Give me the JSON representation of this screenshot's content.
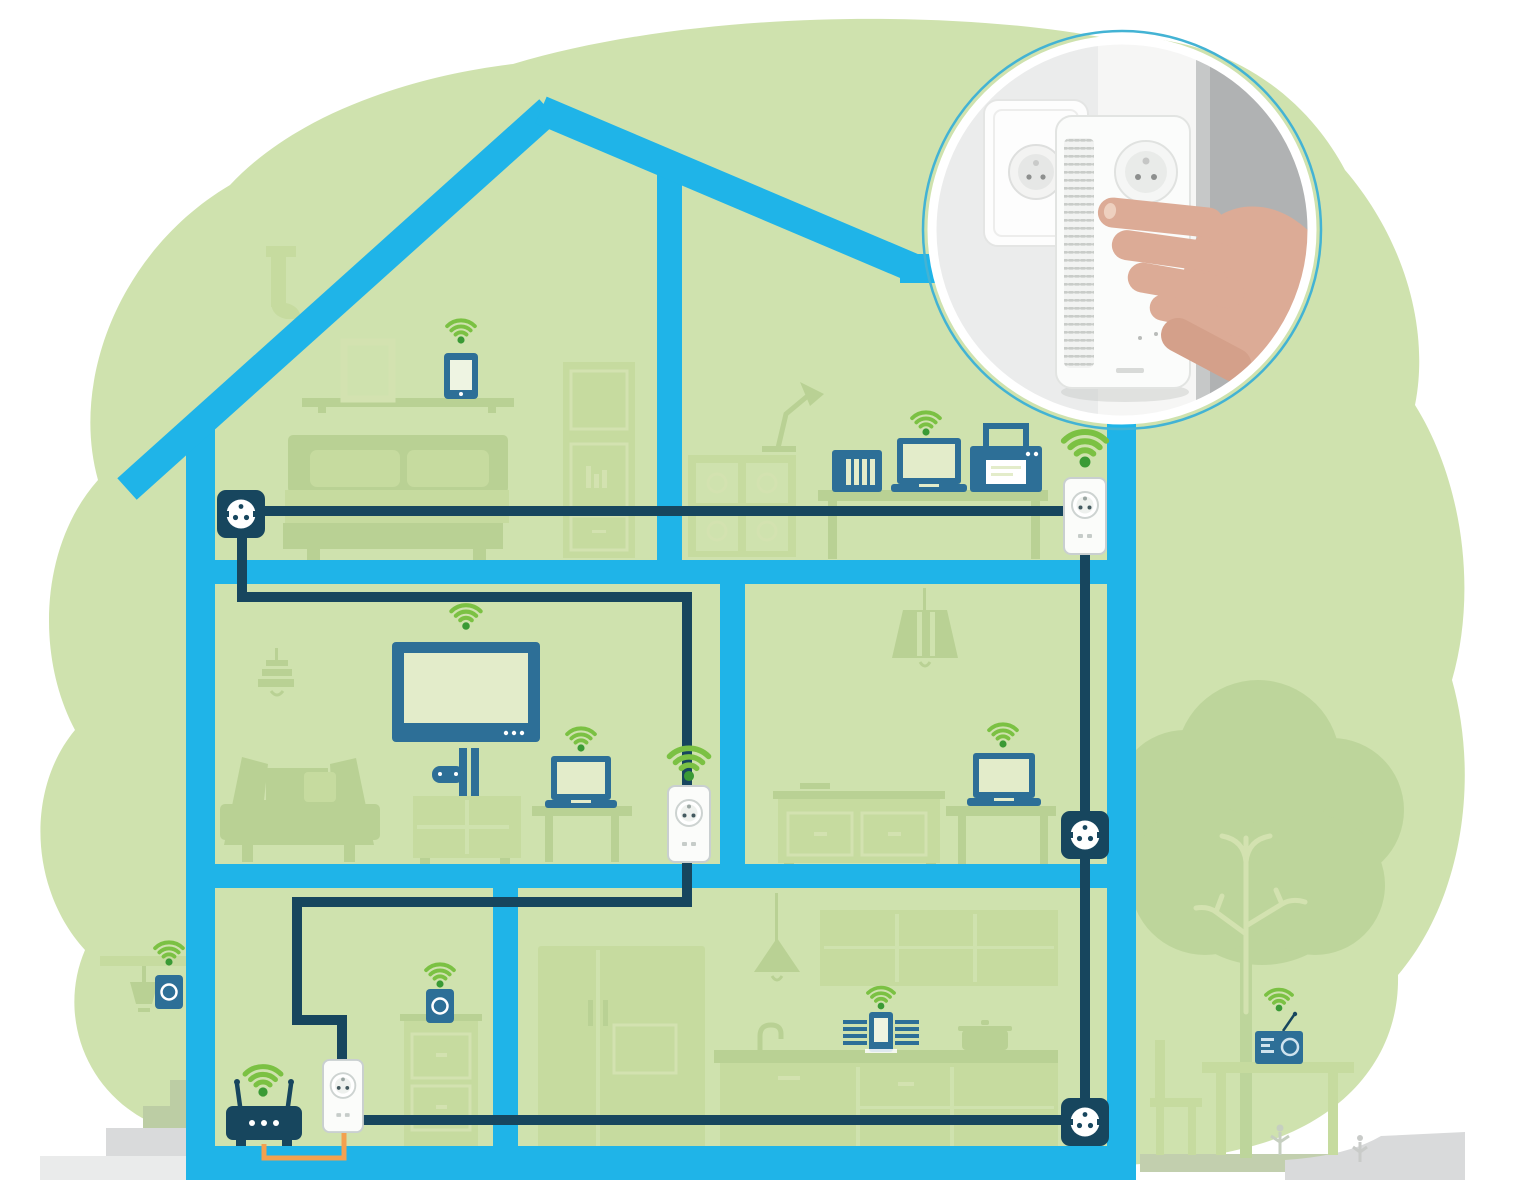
{
  "colors": {
    "page_bg": "#ffffff",
    "blob_green": "#cfe2ae",
    "furniture_green": "#b9d194",
    "furniture_light": "#c6db9f",
    "furniture_outline": "#d3e2b0",
    "tree_green": "#bdd59b",
    "house_blue": "#1fb4e8",
    "cable_navy": "#17465e",
    "device_blue": "#2d6f97",
    "wifi_green": "#7bc143",
    "wifi_dot_green": "#3a9a35",
    "screen_light": "#e3ecca",
    "adapter_white": "#fbfcfa",
    "adapter_border": "#c9cfd0",
    "orange_cable": "#f3a14f",
    "step_green": "#bccda4",
    "ground_gray": "#d9dadb",
    "ground_gray_light": "#eaebeb",
    "photo_wall_light": "#ebecec",
    "photo_wall_mid": "#dcdddd",
    "photo_wall_dark": "#b0b2b3",
    "photo_white": "#f6f6f5",
    "skin": "#dcab96",
    "skin_shadow": "#d4a08a",
    "nail": "#eed0bf",
    "ring_teal": "#43b3d4"
  },
  "scene": {
    "type": "illustration",
    "subject": "powerline-wifi-home-network-cross-section",
    "inset_photo": {
      "name": "adapter-installation-photo",
      "shows": [
        "double-wall-socket",
        "powerline-adapter-with-vents",
        "hand-plugging-adapter"
      ]
    },
    "house": {
      "floors": [
        {
          "name": "attic",
          "rooms": [
            {
              "name": "attic-bedroom",
              "devices": [
                "wifi-tablet",
                "wall-outlet"
              ],
              "furniture": [
                "chimney",
                "picture-frame",
                "wall-shelf",
                "bed",
                "wardrobe"
              ]
            },
            {
              "name": "home-office",
              "devices": [
                "nas-server",
                "wifi-laptop",
                "printer",
                "powerline-adapter-wifi"
              ],
              "furniture": [
                "desk-lamp",
                "shelf-unit",
                "desk"
              ]
            }
          ]
        },
        {
          "name": "middle-floor",
          "rooms": [
            {
              "name": "living-room",
              "devices": [
                "wifi-tv",
                "game-console",
                "wifi-laptop",
                "powerline-adapter-wifi"
              ],
              "furniture": [
                "chandelier",
                "sofa",
                "tv-cabinet",
                "side-table"
              ]
            },
            {
              "name": "bedroom",
              "devices": [
                "wifi-laptop",
                "wall-outlet"
              ],
              "furniture": [
                "pendant-lamp",
                "sideboard",
                "side-table"
              ]
            }
          ]
        },
        {
          "name": "ground-floor",
          "rooms": [
            {
              "name": "router-room",
              "devices": [
                "wifi-router",
                "powerline-adapter",
                "wifi-speaker"
              ],
              "furniture": [
                "drawer-cabinet"
              ]
            },
            {
              "name": "kitchen",
              "devices": [
                "wifi-audio-system",
                "wall-outlet"
              ],
              "furniture": [
                "fridge",
                "pendant-lamp",
                "wall-cabinets",
                "kitchen-counter",
                "sink-faucet",
                "cooking-pot"
              ]
            }
          ]
        }
      ]
    },
    "outdoor": {
      "left": [
        "hanging-basket",
        "wifi-speaker",
        "entrance-steps"
      ],
      "right": [
        "tree",
        "garden-chair",
        "garden-table",
        "wifi-radio",
        "flowers"
      ]
    },
    "network": {
      "wifi_hotspot_count": 12,
      "powerline_adapters": 3,
      "wall_outlets": 4,
      "cables": [
        "attic-outlet-to-office-adapter",
        "attic-outlet-to-living-room-adapter",
        "living-room-adapter-to-ground-floor-adapter",
        "ground-floor-adapter-to-kitchen-outlet",
        "kitchen-outlet-to-bedroom-outlet-to-office-adapter",
        "router-to-adapter-orange-cable"
      ]
    }
  }
}
